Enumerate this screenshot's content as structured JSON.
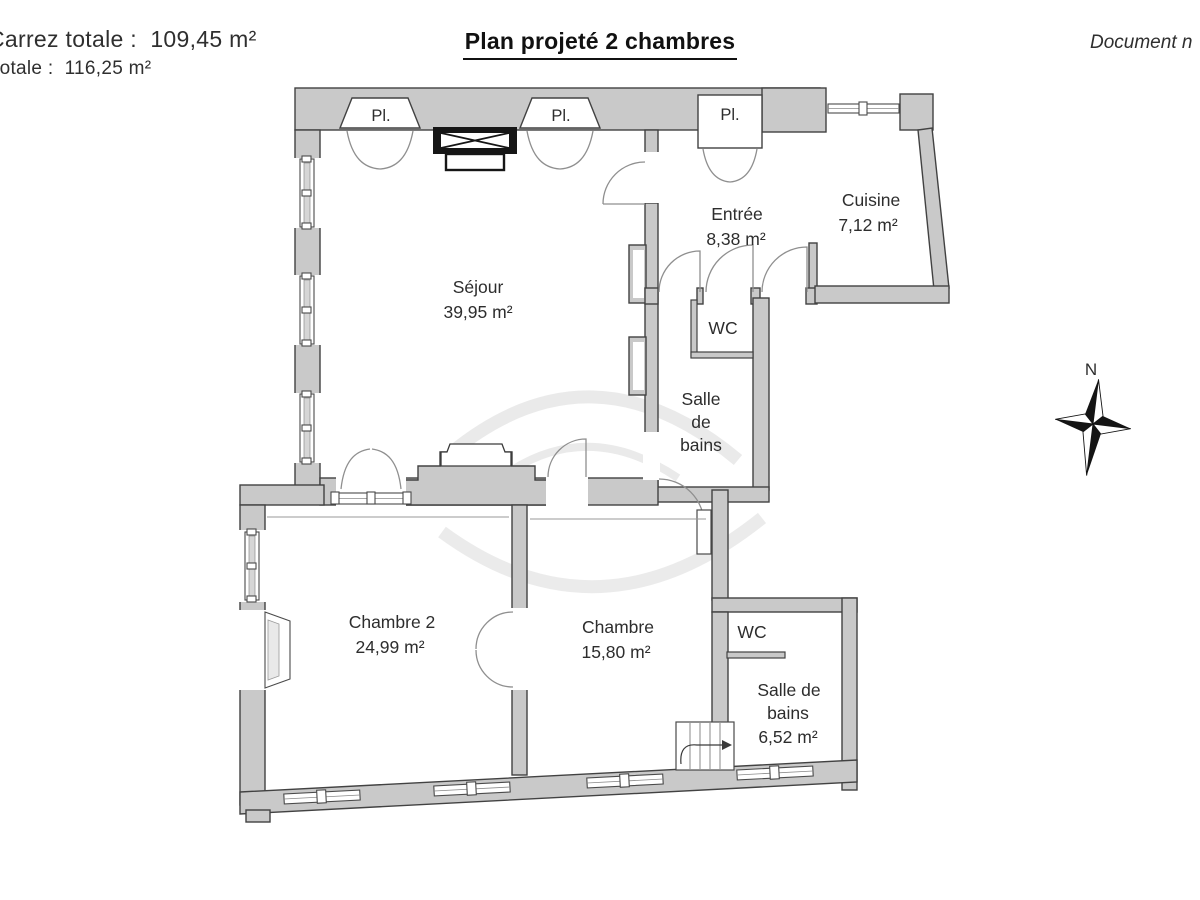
{
  "header": {
    "surface_carrez": "Carrez totale :  109,45 m²",
    "surface_totale": "totale :  116,25 m²",
    "title": "Plan projeté 2 chambres",
    "doc_note": "Document n"
  },
  "plan": {
    "closets": {
      "pl1": "Pl.",
      "pl2": "Pl.",
      "pl3": "Pl."
    },
    "rooms": {
      "sejour": {
        "name": "Séjour",
        "area": "39,95 m²"
      },
      "entree": {
        "name": "Entrée",
        "area": "8,38 m²"
      },
      "cuisine": {
        "name": "Cuisine",
        "area": "7,12 m²"
      },
      "wc_top": {
        "name": "WC"
      },
      "sdb_top": {
        "l1": "Salle",
        "l2": "de",
        "l3": "bains"
      },
      "chambre2": {
        "name": "Chambre 2",
        "area": "24,99 m²"
      },
      "chambre": {
        "name": "Chambre",
        "area": "15,80 m²"
      },
      "wc_bot": {
        "name": "WC"
      },
      "sdb_bot": {
        "l1": "Salle de",
        "l2": "bains",
        "area": "6,52 m²"
      }
    },
    "compass": {
      "north": "N"
    }
  },
  "colors": {
    "wall_fill": "#c9c9c9",
    "wall_stroke": "#424242",
    "door_arc": "#8f8f8f",
    "text": "#2d2d2d",
    "fireplace": "#161616"
  }
}
